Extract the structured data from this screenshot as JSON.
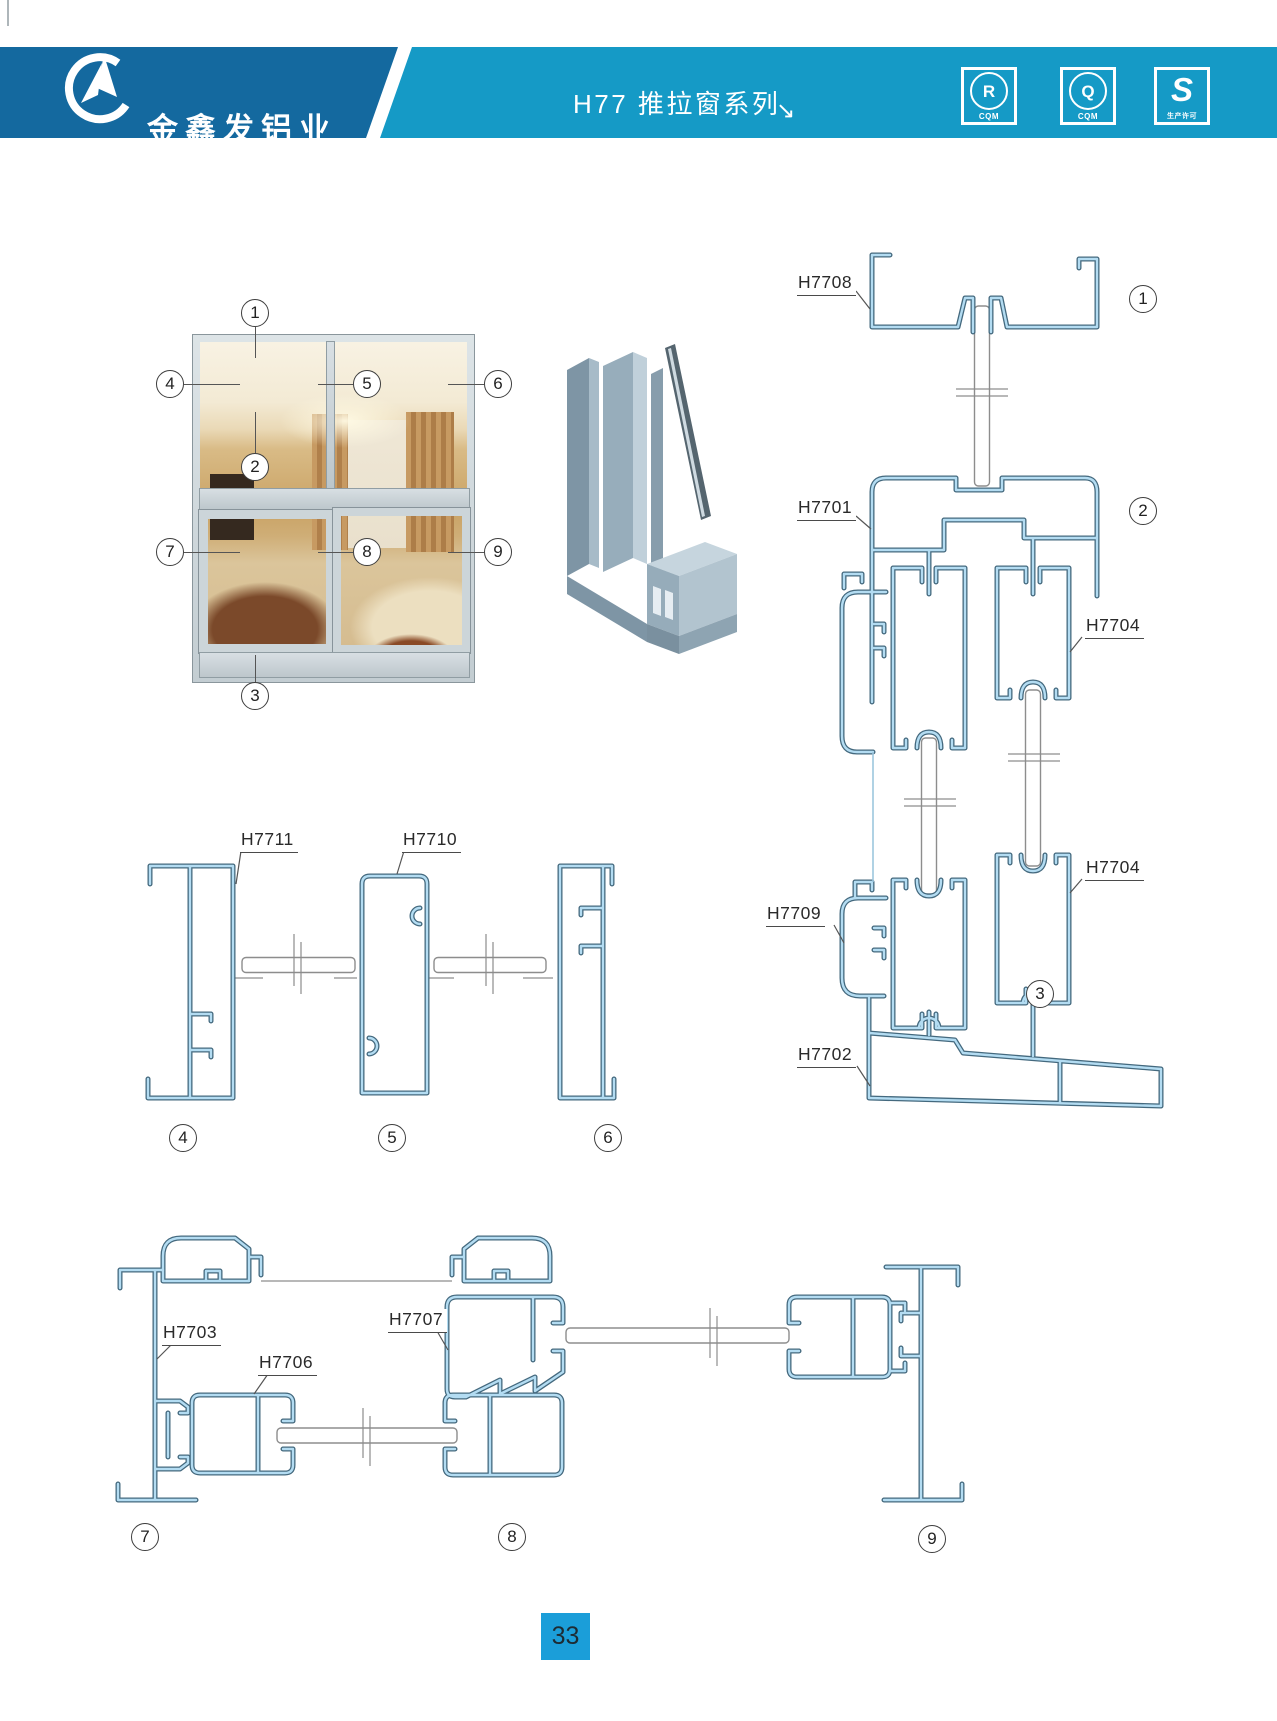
{
  "header": {
    "company_cn": "金鑫发铝业",
    "company_en": "JINXINFA ALUMINUM",
    "title": "H77 推拉窗系列",
    "arrow": "↘",
    "badges": [
      {
        "letter": "R",
        "sub": "CQM"
      },
      {
        "letter": "Q",
        "sub": "CQM"
      },
      {
        "letter": "S",
        "sub": "生产许可"
      }
    ],
    "colors": {
      "dark_blue": "#14699f",
      "light_blue": "#159ac6"
    }
  },
  "photo_callouts": [
    "1",
    "2",
    "3",
    "4",
    "5",
    "6",
    "7",
    "8",
    "9"
  ],
  "section_callouts": [
    "1",
    "2",
    "3",
    "4",
    "5",
    "6",
    "7",
    "8",
    "9"
  ],
  "part_labels": {
    "h7708": "H7708",
    "h7701": "H7701",
    "h7704a": "H7704",
    "h7704b": "H7704",
    "h7709": "H7709",
    "h7702": "H7702",
    "h7711": "H7711",
    "h7710": "H7710",
    "h7703": "H7703",
    "h7706": "H7706",
    "h7707": "H7707"
  },
  "page_number": "33",
  "drawing_colors": {
    "profile_outline": "#44697e",
    "profile_fill": "#b3dcf2",
    "glass_line": "#8d8d8d"
  }
}
